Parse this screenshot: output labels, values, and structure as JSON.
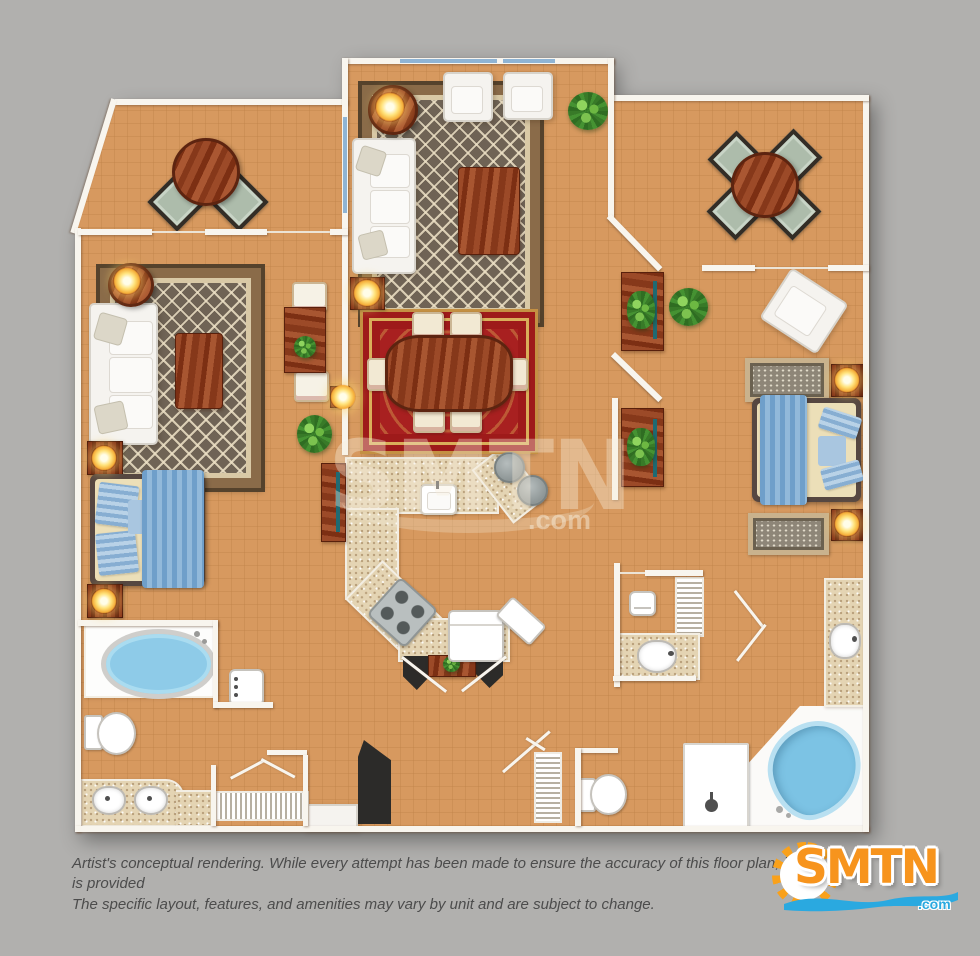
{
  "watermark": {
    "text": "SMTN",
    "suffix": ".com"
  },
  "logo": {
    "text": "SMTN",
    "suffix": ".com",
    "sun_color": "#f9a11b",
    "text_color": "#f7941d",
    "wave_color": "#2aa9e0"
  },
  "disclaimer": {
    "line1": "Artist's conceptual rendering. While every attempt has been made to ensure the accuracy of this floor plan, it is provided",
    "line2": "The specific layout, features, and amenities may vary by unit and are subject to change."
  },
  "palette": {
    "background": "#b1b0ae",
    "floor": "#d7995f",
    "floor_grid": "#be8246",
    "wall": "#f8f5ee",
    "window_blue": "#8fb4d4",
    "rug_brown_border": "#8a6b49",
    "rug_brown_field": "#6f6355",
    "rug_red": "#a82020",
    "rug_red_gold": "#d9ae5a",
    "wood_dark": "#7c2f13",
    "wood_light": "#a85631",
    "counter_speckle": "#e4d4b3",
    "water_blue": "#8ecbe8",
    "bed_blanket_blue": "#6f9fca",
    "lamp_glow": "#ffe27a",
    "chair_sage": "#adbcab",
    "door_black": "#2c2b29"
  },
  "furniture_icons": [
    "sofa",
    "armchair",
    "coffee-table",
    "area-rug",
    "dining-table",
    "dining-chair",
    "round-table",
    "patio-chair",
    "game-table",
    "console-table",
    "bed",
    "nightstand",
    "table-lamp",
    "potted-plant",
    "kitchen-counter",
    "kitchen-sink",
    "stove",
    "refrigerator",
    "bar-stool",
    "bathtub",
    "spa-tub",
    "shower",
    "toilet",
    "vanity-sink",
    "washer",
    "louver-closet",
    "paper-holder",
    "entry-door"
  ]
}
